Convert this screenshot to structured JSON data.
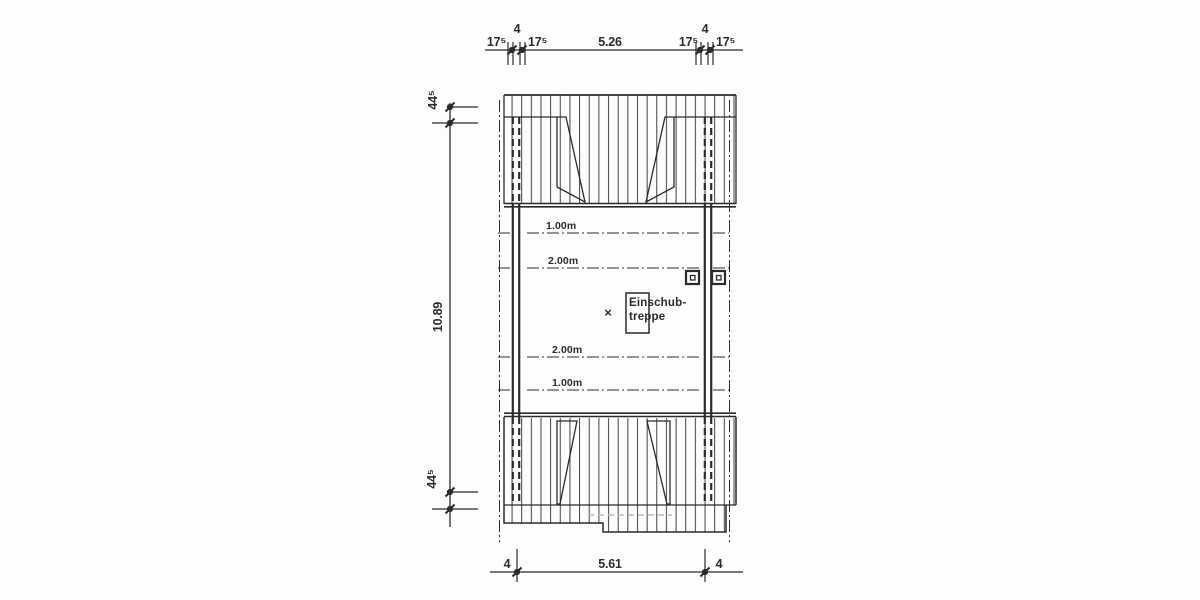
{
  "colors": {
    "ink": "#2b2b2b",
    "paper": "#fdfdfd",
    "faint_line": "#b9b9b9"
  },
  "plan": {
    "room_box_label": {
      "line1": "Einschub-",
      "line2": "treppe"
    },
    "position_marker": "×",
    "contours": {
      "upper_1m": "1.00m",
      "upper_2m": "2.00m",
      "lower_2m": "2.00m",
      "lower_1m": "1.00m"
    }
  },
  "dimensions": {
    "top": {
      "left_outer": "17⁵",
      "left_mid": "4",
      "left_inner": "17⁵",
      "span": "5.26",
      "right_inner": "17⁵",
      "right_mid": "4",
      "right_outer": "17⁵"
    },
    "left": {
      "top_offset": "44⁵",
      "span": "10.89",
      "bottom_offset": "44⁵"
    },
    "bottom": {
      "left_wall": "4",
      "span": "5.61",
      "right_wall": "4"
    }
  }
}
